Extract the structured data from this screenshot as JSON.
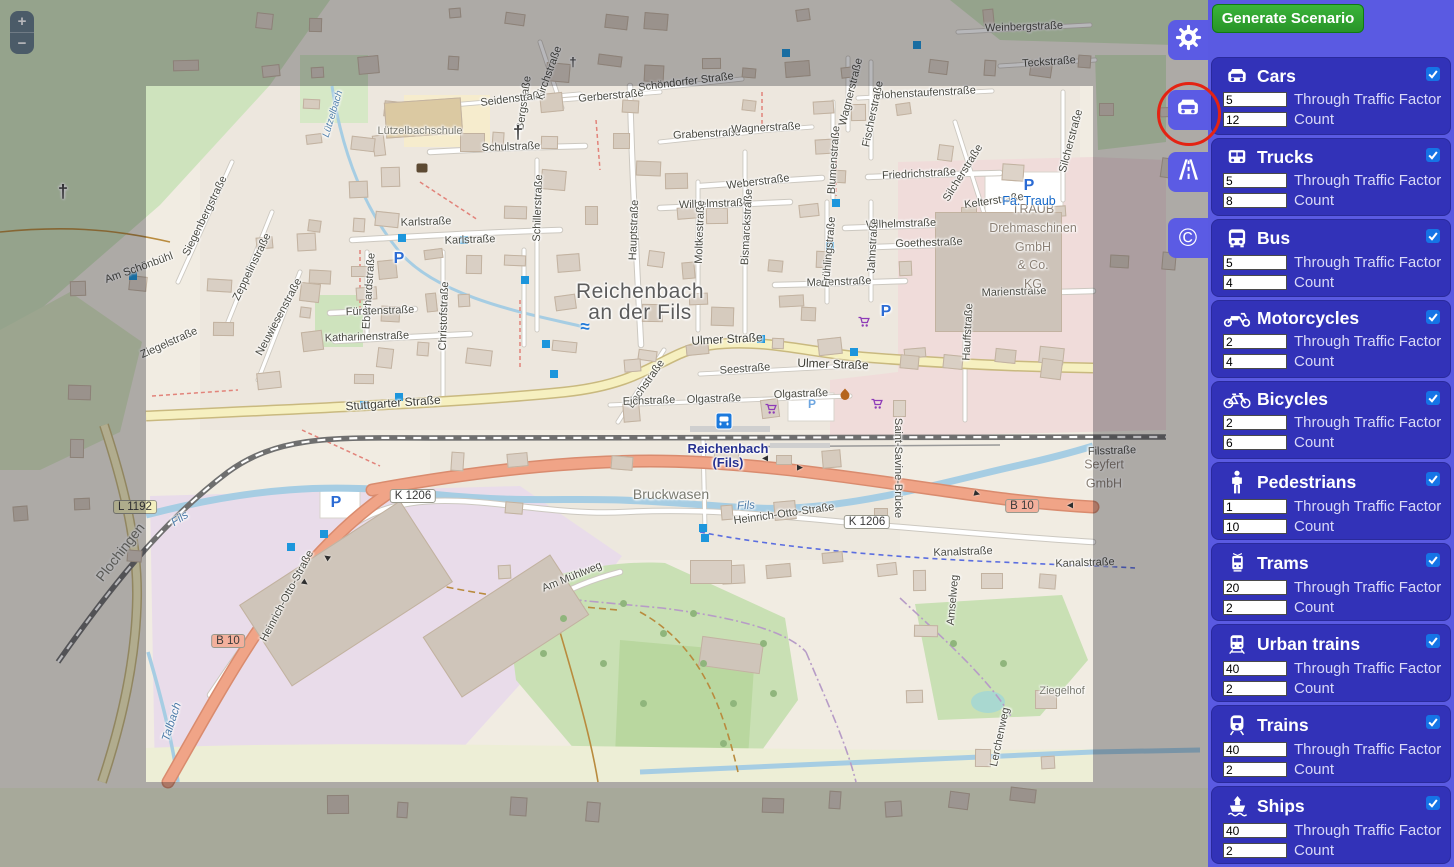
{
  "app": {
    "generate_button": "Generate Scenario"
  },
  "zoom_controls": {
    "zoom_in": "+",
    "zoom_out": "−"
  },
  "toolbar": {
    "tabs": [
      {
        "id": "settings",
        "icon": "gear-icon"
      },
      {
        "id": "vehicles",
        "icon": "car-icon",
        "active": true,
        "annotation": "red-circle"
      },
      {
        "id": "roads",
        "icon": "road-icon"
      },
      {
        "id": "copyright",
        "icon": "copyright-icon",
        "glyph": "©"
      }
    ]
  },
  "panel": {
    "fields": {
      "through_label": "Through Traffic Factor",
      "count_label": "Count"
    },
    "vehicles": [
      {
        "name": "Cars",
        "icon": "car",
        "checked": true,
        "through": "5",
        "count": "12"
      },
      {
        "name": "Trucks",
        "icon": "truck",
        "checked": true,
        "through": "5",
        "count": "8"
      },
      {
        "name": "Bus",
        "icon": "bus",
        "checked": true,
        "through": "5",
        "count": "4"
      },
      {
        "name": "Motorcycles",
        "icon": "motorcycle",
        "checked": true,
        "through": "2",
        "count": "4"
      },
      {
        "name": "Bicycles",
        "icon": "bicycle",
        "checked": true,
        "through": "2",
        "count": "6"
      },
      {
        "name": "Pedestrians",
        "icon": "pedestrian",
        "checked": true,
        "through": "1",
        "count": "10"
      },
      {
        "name": "Trams",
        "icon": "tram",
        "checked": true,
        "through": "20",
        "count": "2"
      },
      {
        "name": "Urban trains",
        "icon": "urban-train",
        "checked": true,
        "through": "40",
        "count": "2"
      },
      {
        "name": "Trains",
        "icon": "train",
        "checked": true,
        "through": "40",
        "count": "2"
      },
      {
        "name": "Ships",
        "icon": "ship",
        "checked": true,
        "through": "40",
        "count": "2"
      }
    ]
  },
  "colors": {
    "panel_bg": "#5a5ae2",
    "card_bg": "#3232b8",
    "tab_bg": "#5b5be4",
    "button_green": "#2fa336",
    "checkbox_blue": "#1574e6",
    "annotation_red": "#e42313",
    "marker_blue": "#1d96dc"
  },
  "map": {
    "arrow_glyph": "►",
    "labels": [
      {
        "t": "Reichenbach\nan der Fils",
        "x": 640,
        "y": 302,
        "c": "city"
      },
      {
        "t": "Reichenbach\n(Fils)",
        "x": 728,
        "y": 456,
        "c": "station"
      },
      {
        "t": "Ulmer Straße",
        "x": 727,
        "y": 339,
        "r": -3,
        "c": "sl"
      },
      {
        "t": "Ulmer Straße",
        "x": 833,
        "y": 364,
        "r": 2,
        "c": "sl"
      },
      {
        "t": "Stuttgarter Straße",
        "x": 393,
        "y": 403,
        "r": -4,
        "c": "sl"
      },
      {
        "t": "Bachstraße",
        "x": 646,
        "y": 384,
        "r": -55
      },
      {
        "t": "Seestraße",
        "x": 745,
        "y": 369,
        "r": -4
      },
      {
        "t": "Eichstraße",
        "x": 649,
        "y": 401,
        "r": -2
      },
      {
        "t": "Olgastraße",
        "x": 714,
        "y": 399,
        "r": -2
      },
      {
        "t": "Olgastraße",
        "x": 801,
        "y": 394,
        "r": -2
      },
      {
        "t": "Hauptstraße",
        "x": 634,
        "y": 230,
        "r": -88
      },
      {
        "t": "Schulstraße",
        "x": 511,
        "y": 147,
        "r": -2
      },
      {
        "t": "Bergstraße",
        "x": 524,
        "y": 103,
        "r": -82
      },
      {
        "t": "Schillerstraße",
        "x": 538,
        "y": 208,
        "r": -88
      },
      {
        "t": "Seidenstraße",
        "x": 513,
        "y": 99,
        "r": -7
      },
      {
        "t": "Gerberstraße",
        "x": 611,
        "y": 96,
        "r": -5
      },
      {
        "t": "Schöndorfer Straße",
        "x": 686,
        "y": 82,
        "r": -7
      },
      {
        "t": "Grabenstraße",
        "x": 707,
        "y": 134,
        "r": -3
      },
      {
        "t": "Wagnerstraße",
        "x": 766,
        "y": 128,
        "r": -3
      },
      {
        "t": "Wagnerstraße",
        "x": 851,
        "y": 92,
        "r": -76
      },
      {
        "t": "Hohenstaufenstraße",
        "x": 926,
        "y": 93,
        "r": -3
      },
      {
        "t": "Fischerstraße",
        "x": 873,
        "y": 114,
        "r": -78
      },
      {
        "t": "Blumenstraße",
        "x": 834,
        "y": 160,
        "r": -86
      },
      {
        "t": "Kirchstraße",
        "x": 549,
        "y": 73,
        "r": -70
      },
      {
        "t": "Karlstraße",
        "x": 426,
        "y": 222,
        "r": -2
      },
      {
        "t": "Karlstraße",
        "x": 470,
        "y": 240,
        "r": -2
      },
      {
        "t": "Eberhardstraße",
        "x": 369,
        "y": 291,
        "r": -86
      },
      {
        "t": "Christofstraße",
        "x": 444,
        "y": 316,
        "r": -88
      },
      {
        "t": "Fürstenstraße",
        "x": 380,
        "y": 311,
        "r": -2
      },
      {
        "t": "Katharinenstraße",
        "x": 367,
        "y": 337,
        "r": -2
      },
      {
        "t": "Neuwiesenstraße",
        "x": 279,
        "y": 317,
        "r": -62
      },
      {
        "t": "Siegenbergstraße",
        "x": 205,
        "y": 216,
        "r": -64
      },
      {
        "t": "Zeppelinstraße",
        "x": 252,
        "y": 267,
        "r": -64
      },
      {
        "t": "Am Schönbühl",
        "x": 139,
        "y": 268,
        "r": -20
      },
      {
        "t": "Ziegelstraße",
        "x": 169,
        "y": 343,
        "r": -24
      },
      {
        "t": "Wilhelmstraße",
        "x": 714,
        "y": 204,
        "r": -2
      },
      {
        "t": "Wilhelmstraße",
        "x": 901,
        "y": 224,
        "r": -2
      },
      {
        "t": "Weberstraße",
        "x": 758,
        "y": 182,
        "r": -7
      },
      {
        "t": "Friedrichstraße",
        "x": 919,
        "y": 174,
        "r": -3
      },
      {
        "t": "Kelterstraße",
        "x": 994,
        "y": 201,
        "r": -8
      },
      {
        "t": "Goethestraße",
        "x": 929,
        "y": 243,
        "r": -2
      },
      {
        "t": "Marienstraße",
        "x": 839,
        "y": 282,
        "r": -2
      },
      {
        "t": "Marienstraße",
        "x": 1014,
        "y": 292,
        "r": -2
      },
      {
        "t": "Bismarckstraße",
        "x": 747,
        "y": 227,
        "r": -87
      },
      {
        "t": "Frühlingstraße",
        "x": 829,
        "y": 252,
        "r": -85
      },
      {
        "t": "Jahnstraße",
        "x": 873,
        "y": 246,
        "r": -87
      },
      {
        "t": "Moltkestraße",
        "x": 700,
        "y": 232,
        "r": -88
      },
      {
        "t": "Silcherstraße",
        "x": 1071,
        "y": 141,
        "r": -75
      },
      {
        "t": "Silcherstraße",
        "x": 963,
        "y": 173,
        "r": -58
      },
      {
        "t": "Hauffstraße",
        "x": 968,
        "y": 332,
        "r": -87
      },
      {
        "t": "Teckstraße",
        "x": 1049,
        "y": 62,
        "r": -4
      },
      {
        "t": "Weinbergstraße",
        "x": 1024,
        "y": 27,
        "r": -2
      },
      {
        "t": "Bruckwasen",
        "x": 671,
        "y": 494,
        "c": "area"
      },
      {
        "t": "Fils",
        "x": 746,
        "y": 506,
        "r": -4,
        "c": "w"
      },
      {
        "t": "Fils",
        "x": 180,
        "y": 519,
        "r": -33,
        "c": "w"
      },
      {
        "t": "Heinrich-Otto-Straße",
        "x": 287,
        "y": 596,
        "r": -62
      },
      {
        "t": "Heinrich-Otto-Straße",
        "x": 784,
        "y": 514,
        "r": -8
      },
      {
        "t": "Saint-Savine-Brücke",
        "x": 898,
        "y": 468,
        "r": 90
      },
      {
        "t": "Kanalstraße",
        "x": 963,
        "y": 552,
        "r": -2
      },
      {
        "t": "Kanalstraße",
        "x": 1085,
        "y": 563,
        "r": -2
      },
      {
        "t": "Filsstraße",
        "x": 1112,
        "y": 451,
        "r": -2
      },
      {
        "t": "Seyfert\nGmbH",
        "x": 1104,
        "y": 474,
        "c": "bld"
      },
      {
        "t": "TRAUB\nDrehmaschinen\nGmbH\n& Co.\nKG",
        "x": 1033,
        "y": 247,
        "c": "bld"
      },
      {
        "t": "Fa. Traub",
        "x": 1029,
        "y": 201,
        "c": "poiblue"
      },
      {
        "t": "Lützelbachschule",
        "x": 420,
        "y": 131,
        "c": "areasm"
      },
      {
        "t": "Lützelbach",
        "x": 333,
        "y": 114,
        "r": -73,
        "c": "ws"
      },
      {
        "t": "Talbach",
        "x": 172,
        "y": 722,
        "r": -72,
        "c": "w"
      },
      {
        "t": "Plochingen",
        "x": 120,
        "y": 552,
        "r": -52,
        "c": "area"
      },
      {
        "t": "Ziegelhof",
        "x": 1062,
        "y": 691,
        "c": "areasm"
      },
      {
        "t": "Am Mühlweg",
        "x": 572,
        "y": 577,
        "r": -22
      },
      {
        "t": "Amselweg",
        "x": 953,
        "y": 600,
        "r": -85
      },
      {
        "t": "Lerchenweg",
        "x": 1000,
        "y": 737,
        "r": -78
      },
      {
        "t": "K 1206",
        "x": 413,
        "y": 496,
        "c": "sh"
      },
      {
        "t": "K 1206",
        "x": 867,
        "y": 522,
        "c": "sh"
      },
      {
        "t": "B 10",
        "x": 228,
        "y": 641,
        "c": "shb"
      },
      {
        "t": "B 10",
        "x": 1022,
        "y": 506,
        "c": "shb"
      },
      {
        "t": "L 1192",
        "x": 135,
        "y": 507,
        "c": "shl"
      },
      {
        "t": "P",
        "x": 399,
        "y": 259,
        "c": "park"
      },
      {
        "t": "P",
        "x": 1029,
        "y": 186,
        "c": "park"
      },
      {
        "t": "P",
        "x": 886,
        "y": 312,
        "c": "park"
      },
      {
        "t": "P",
        "x": 336,
        "y": 503,
        "c": "park"
      },
      {
        "t": "P",
        "x": 812,
        "y": 404,
        "c": "parksm"
      },
      {
        "t": "†",
        "x": 518,
        "y": 133,
        "c": "cross"
      },
      {
        "t": "†",
        "x": 573,
        "y": 62,
        "c": "crosssm"
      },
      {
        "t": "†",
        "x": 63,
        "y": 192,
        "c": "cross"
      }
    ],
    "markers": [
      {
        "x": 133,
        "y": 276
      },
      {
        "x": 291,
        "y": 547
      },
      {
        "x": 324,
        "y": 534
      },
      {
        "x": 364,
        "y": 405
      },
      {
        "x": 399,
        "y": 397
      },
      {
        "x": 402,
        "y": 238
      },
      {
        "x": 464,
        "y": 240
      },
      {
        "x": 525,
        "y": 280
      },
      {
        "x": 546,
        "y": 344
      },
      {
        "x": 554,
        "y": 374
      },
      {
        "x": 703,
        "y": 528
      },
      {
        "x": 705,
        "y": 538
      },
      {
        "x": 761,
        "y": 339
      },
      {
        "x": 786,
        "y": 53
      },
      {
        "x": 836,
        "y": 203
      },
      {
        "x": 830,
        "y": 246
      },
      {
        "x": 854,
        "y": 352
      },
      {
        "x": 917,
        "y": 45
      }
    ],
    "arrows": [
      {
        "x": 765,
        "y": 458,
        "r": 180
      },
      {
        "x": 800,
        "y": 468,
        "r": 0
      },
      {
        "x": 977,
        "y": 494,
        "r": 15
      },
      {
        "x": 1070,
        "y": 505,
        "r": 180
      },
      {
        "x": 327,
        "y": 557,
        "r": 215
      },
      {
        "x": 305,
        "y": 583,
        "r": 35
      }
    ],
    "pois": [
      {
        "type": "bus-stop",
        "x": 724,
        "y": 421
      },
      {
        "type": "cart",
        "x": 771,
        "y": 411
      },
      {
        "type": "cart",
        "x": 877,
        "y": 406
      },
      {
        "type": "cart",
        "x": 864,
        "y": 324
      },
      {
        "type": "flame",
        "x": 845,
        "y": 397
      },
      {
        "type": "waves",
        "glyph": "≈",
        "x": 585,
        "y": 327
      },
      {
        "type": "book",
        "x": 422,
        "y": 168
      }
    ]
  }
}
